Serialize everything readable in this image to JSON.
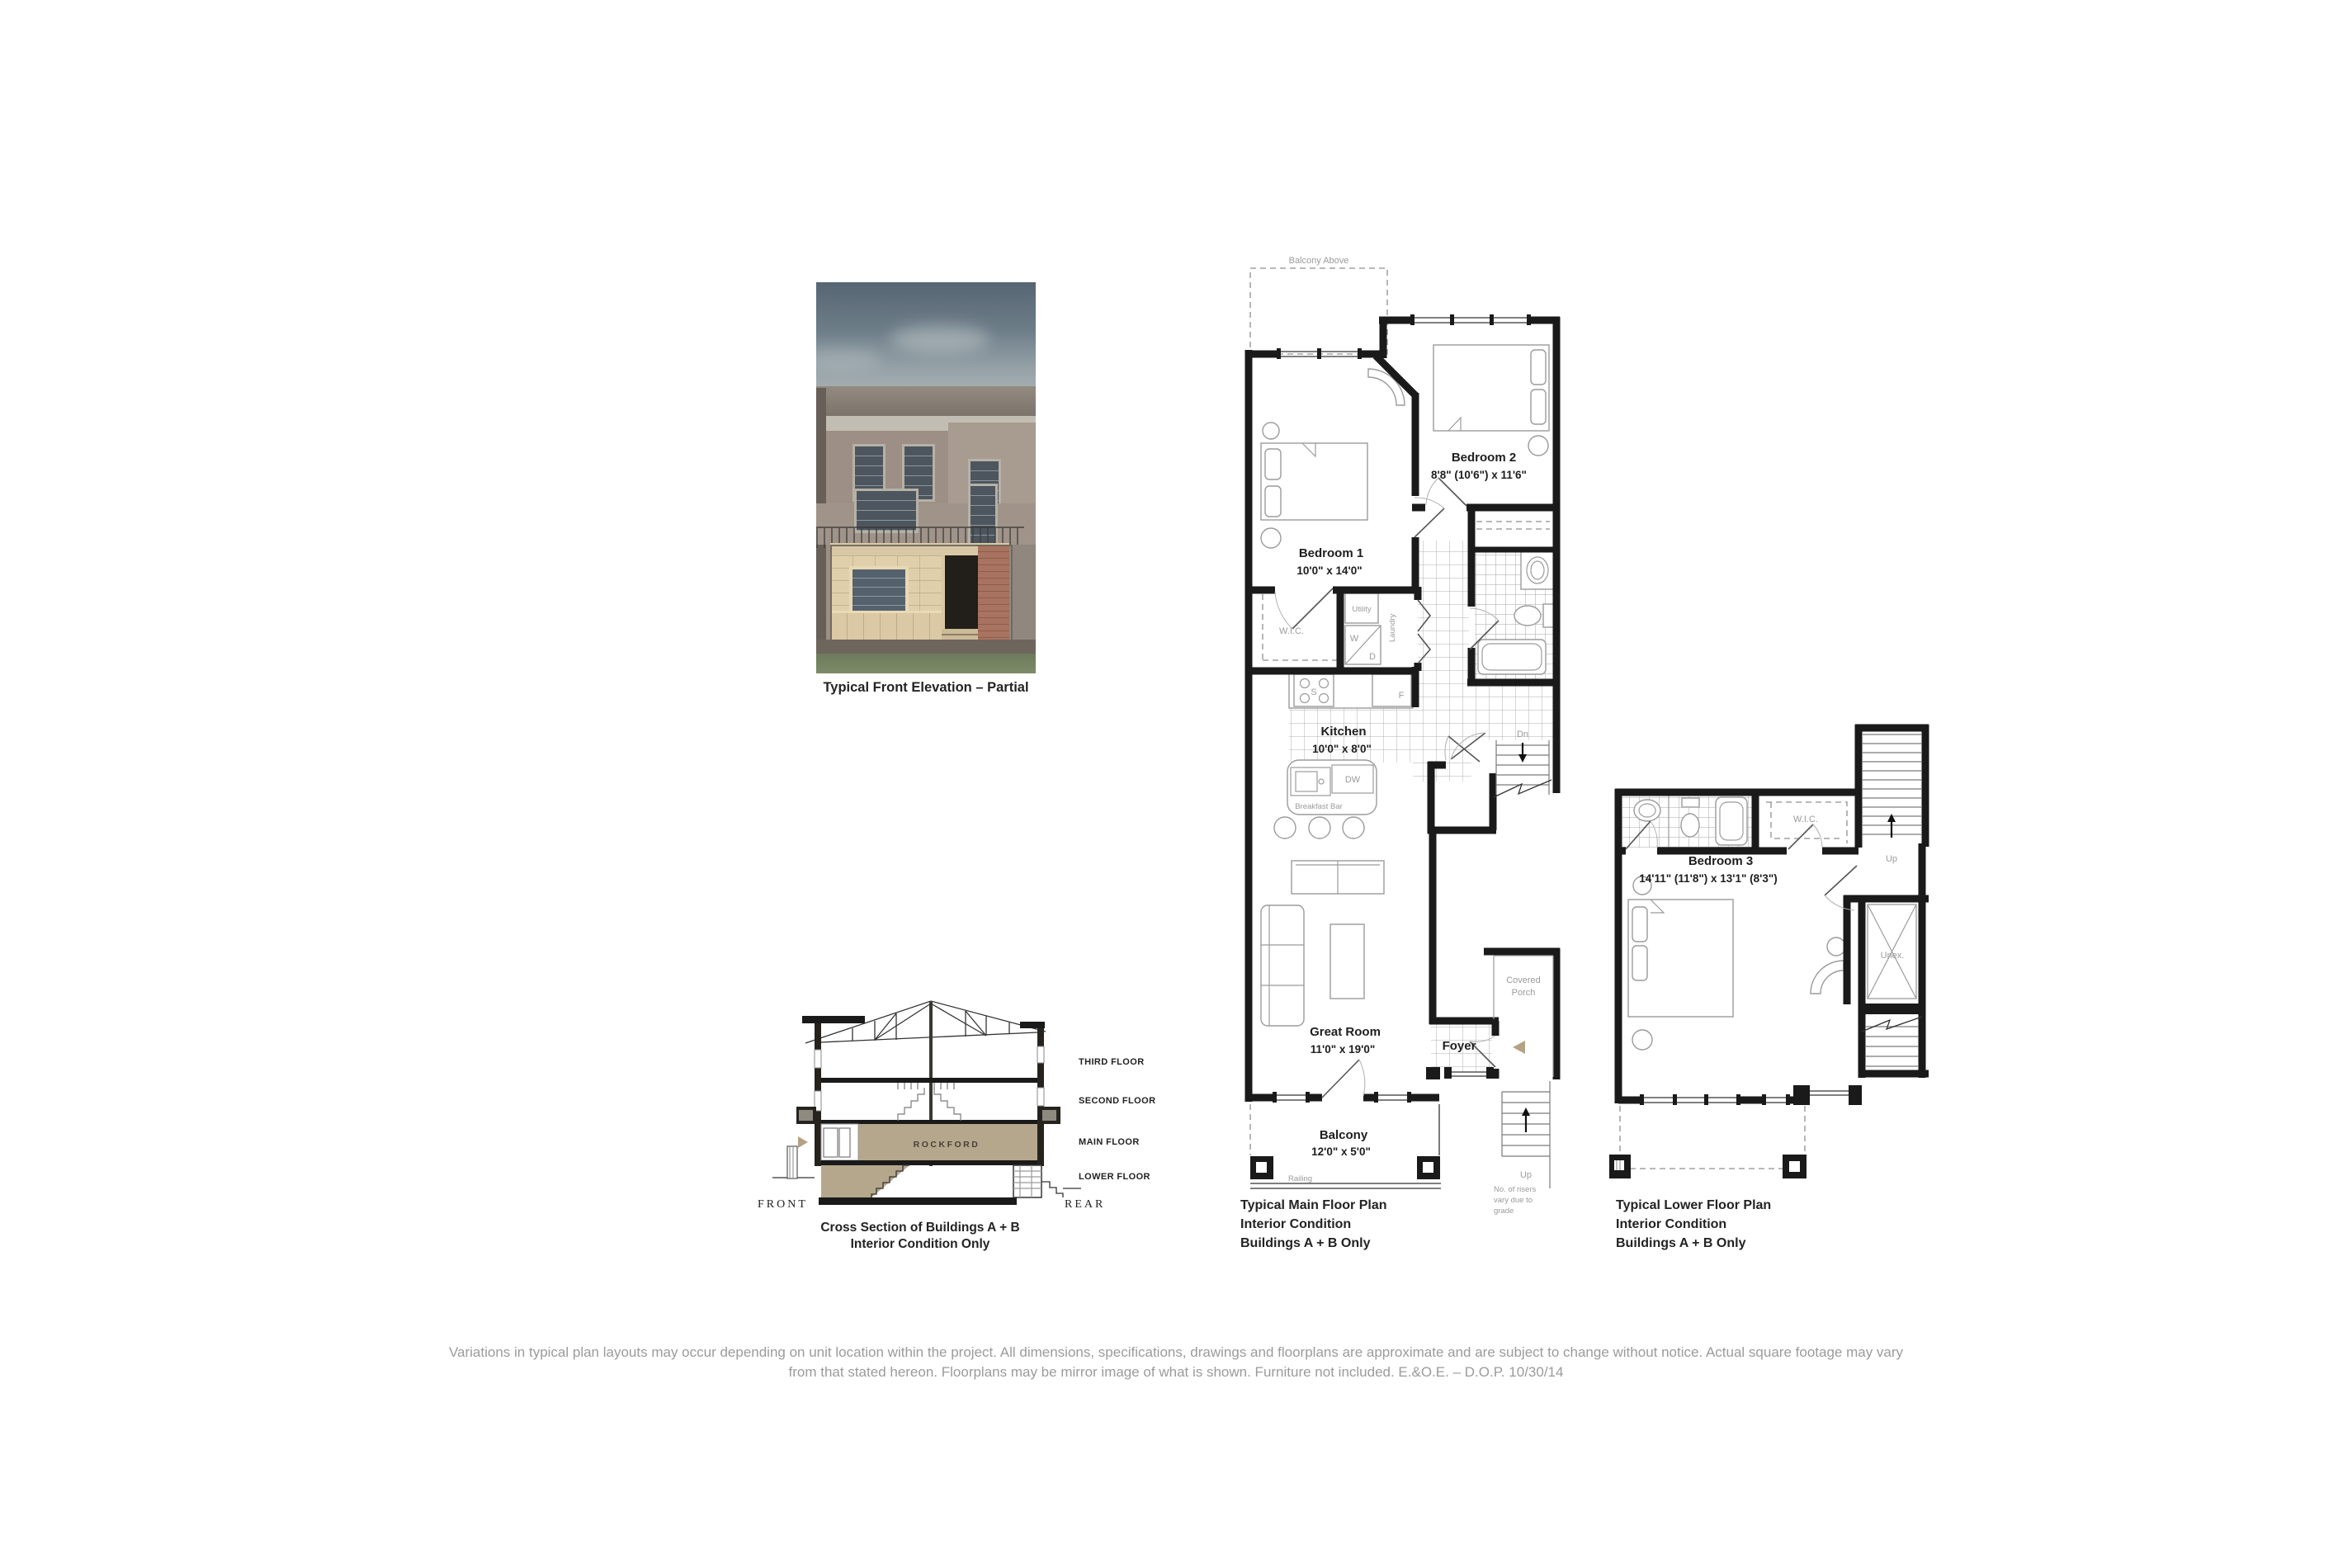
{
  "colors": {
    "accent_tan": "#b3a283",
    "wall_black": "#1a1a1a",
    "label_gray": "#9b9b9b",
    "disclaimer_gray": "#9b9b9b",
    "rockford_band": "#b5a78c"
  },
  "elevation": {
    "caption": "Typical Front Elevation – Partial"
  },
  "cross_section": {
    "floors": [
      "THIRD FLOOR",
      "SECOND FLOOR",
      "MAIN FLOOR",
      "LOWER FLOOR"
    ],
    "brand": "ROCKFORD",
    "front_label": "FRONT",
    "rear_label": "REAR",
    "caption_line1": "Cross Section of Buildings A + B",
    "caption_line2": "Interior Condition Only"
  },
  "main_plan": {
    "balcony_above": "Balcony Above",
    "bedroom1": {
      "name": "Bedroom 1",
      "dims": "10'0\" x 14'0\""
    },
    "bedroom2": {
      "name": "Bedroom 2",
      "dims": "8'8\" (10'6\") x 11'6\""
    },
    "wic": "W.I.C.",
    "utility": "Utility",
    "washer": "W",
    "dryer": "D",
    "laundry": "Laundry",
    "stove": "S",
    "fridge": "F",
    "dishwasher": "DW",
    "kitchen": {
      "name": "Kitchen",
      "dims": "10'0\" x 8'0\""
    },
    "breakfast_bar": "Breakfast Bar",
    "dn": "Dn",
    "great_room": {
      "name": "Great Room",
      "dims": "11'0\" x 19'0\""
    },
    "foyer": "Foyer",
    "covered_porch_line1": "Covered",
    "covered_porch_line2": "Porch",
    "balcony": {
      "name": "Balcony",
      "dims": "12'0\" x 5'0\""
    },
    "railing": "Railing",
    "up": "Up",
    "risers_note": [
      "No. of risers",
      "vary due to",
      "grade"
    ],
    "caption": [
      "Typical Main Floor Plan",
      "Interior Condition",
      "Buildings A + B Only"
    ]
  },
  "lower_plan": {
    "bedroom3": {
      "name": "Bedroom 3",
      "dims": "14'11\" (11'8\") x 13'1\" (8'3\")"
    },
    "wic": "W.I.C.",
    "up": "Up",
    "unex": "Unex.",
    "caption": [
      "Typical Lower Floor Plan",
      "Interior Condition",
      "Buildings A + B Only"
    ]
  },
  "disclaimer": {
    "line1": "Variations in typical plan layouts may occur depending on unit location within the project. All dimensions, specifications, drawings and floorplans are approximate and are subject to change without notice. Actual square footage may vary",
    "line2": "from that stated hereon. Floorplans may be mirror image of what is shown. Furniture not included. E.&O.E. – D.O.P. 10/30/14"
  }
}
